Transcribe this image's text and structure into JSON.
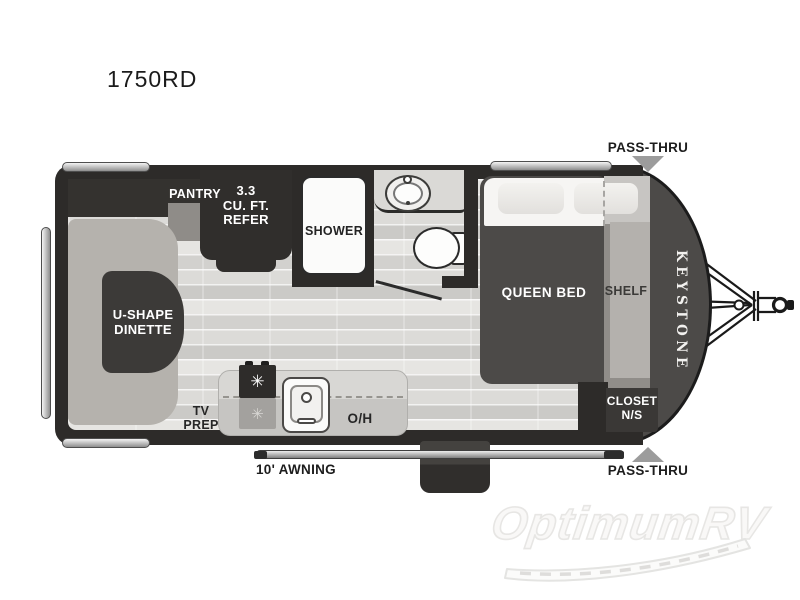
{
  "page": {
    "title": "1750RD"
  },
  "floorplan": {
    "brand_vertical": "KEYSTONE",
    "labels": {
      "pantry": "PANTRY",
      "refer": [
        "3.3",
        "CU. FT.",
        "REFER"
      ],
      "shower": "SHOWER",
      "dinette": [
        "U-SHAPE",
        "DINETTE"
      ],
      "tv_prep": [
        "TV",
        "PREP"
      ],
      "overhead": "O/H",
      "awning": "10' AWNING",
      "queen_bed": "QUEEN BED",
      "shelf": "SHELF",
      "closet": [
        "CLOSET",
        "N/S"
      ],
      "pass_thru_top": "PASS-THRU",
      "pass_thru_bottom": "PASS-THRU"
    },
    "colors": {
      "wall": "#2d2b29",
      "nose": "#4c4a48",
      "floor_base": "#dedcd9",
      "bench": "#b5b2ad",
      "table": "#3c3a38",
      "counter": "#d0cfcc",
      "bed": "#4c4a48",
      "shelf_band": "#908d89",
      "pass_thru_arrow": "#9c9c9c",
      "accent_silver": "#cfcfcf",
      "label_light": "#ffffff",
      "label_dark": "#1d1d1d"
    }
  },
  "watermark": {
    "text": "OptimumRV"
  }
}
